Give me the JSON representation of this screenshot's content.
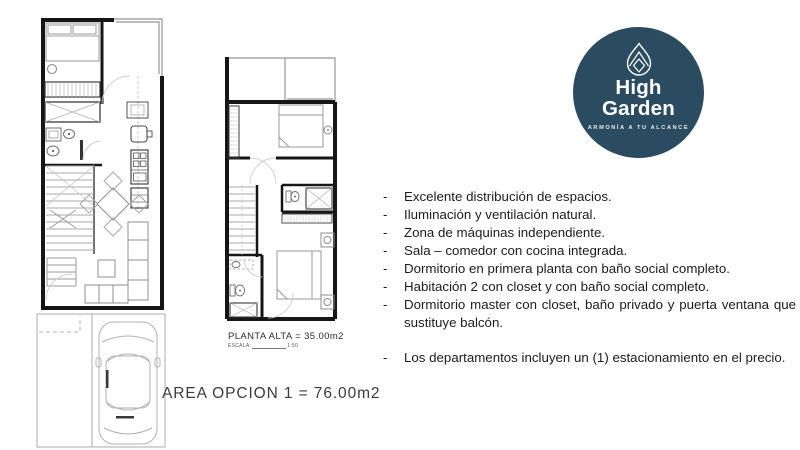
{
  "plans": {
    "ground": {
      "name": "planta baja con estacionamiento"
    },
    "upper": {
      "label": "PLANTA ALTA = 35.00m2",
      "scale_label": "ESCALA:",
      "scale_value": "1:50"
    },
    "area_label": "AREA OPCION 1 = 76.00m2"
  },
  "logo": {
    "name_line1": "High",
    "name_line2": "Garden",
    "tagline": "ARMONÍA A TU ALCANCE",
    "bg_color": "#2b4c60",
    "text_color": "#ffffff",
    "icon": "water-drop-mountain-icon"
  },
  "features": {
    "marker": "-",
    "items": [
      "Excelente distribución de espacios.",
      "Iluminación y ventilación natural.",
      "Zona de máquinas independiente.",
      "Sala – comedor con cocina integrada.",
      "Dormitorio en primera planta  con baño social completo.",
      "Habitación 2 con closet y con baño social completo.",
      "Dormitorio master con closet, baño privado y puerta ventana que sustituye balcón."
    ],
    "items2": [
      "Los departamentos incluyen un (1) estacionamiento en el precio."
    ]
  }
}
